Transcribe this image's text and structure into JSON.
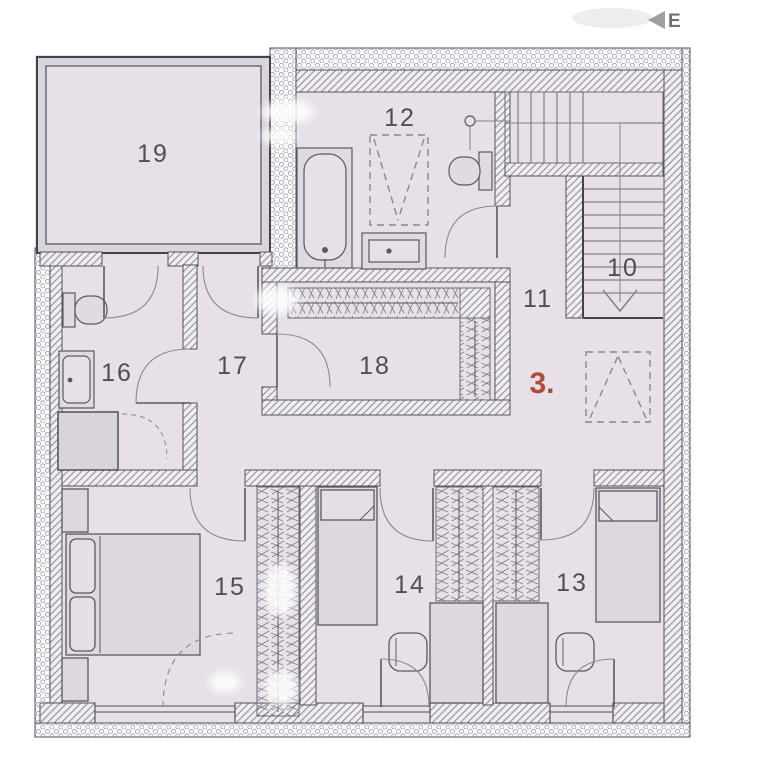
{
  "plan": {
    "unit_label": "3.",
    "watermark_letter": "E",
    "rooms": [
      {
        "label": "19"
      },
      {
        "label": "12"
      },
      {
        "label": "10"
      },
      {
        "label": "11"
      },
      {
        "label": "16"
      },
      {
        "label": "17"
      },
      {
        "label": "18"
      },
      {
        "label": "15"
      },
      {
        "label": "14"
      },
      {
        "label": "13"
      }
    ],
    "colors": {
      "floor": "#e7e0e8",
      "furniture": "#ded8e1",
      "wall_line": "#45424c",
      "hatch_line": "#8f8b97",
      "label_text": "#504d58",
      "accent_red": "#b14a36"
    }
  }
}
